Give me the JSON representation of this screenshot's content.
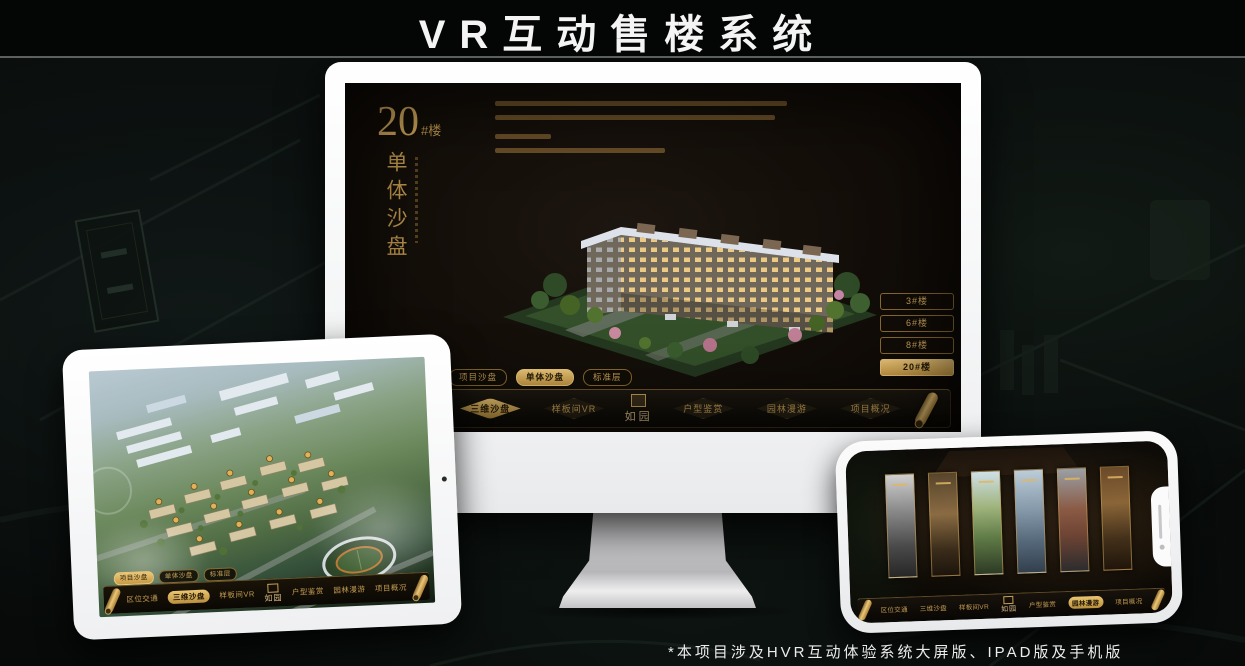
{
  "page": {
    "title": "VR互动售楼系统",
    "footnote": "*本项目涉及HVR互动体验系统大屏版、IPAD版及手机版"
  },
  "colors": {
    "gold": "#C9A158",
    "gold_bright": "#ECC779",
    "active_tab_bg": "#C79A44",
    "screen_bg": "#120D08",
    "title_text": "#F4F4F4"
  },
  "monitor": {
    "heading": {
      "number": "20",
      "suffix": "#楼",
      "vertical": "单体沙盘"
    },
    "floor_buttons": [
      {
        "label": "3#楼",
        "active": false
      },
      {
        "label": "6#楼",
        "active": false
      },
      {
        "label": "8#楼",
        "active": false
      },
      {
        "label": "20#楼",
        "active": true
      }
    ],
    "tabs": [
      {
        "label": "项目沙盘",
        "active": false
      },
      {
        "label": "单体沙盘",
        "active": true
      },
      {
        "label": "标准层",
        "active": false
      }
    ],
    "nav": {
      "left": [
        "区位交通",
        "三维沙盘",
        "样板间VR"
      ],
      "right": [
        "户型鉴赏",
        "园林漫游",
        "项目概况"
      ],
      "active": "三维沙盘",
      "logo": "如园"
    }
  },
  "tablet": {
    "tabs": [
      {
        "label": "项目沙盘",
        "active": true
      },
      {
        "label": "单体沙盘",
        "active": false
      },
      {
        "label": "标准层",
        "active": false
      }
    ],
    "nav": {
      "left": [
        "区位交通",
        "三维沙盘",
        "样板间VR"
      ],
      "right": [
        "户型鉴赏",
        "园林漫游",
        "项目概况"
      ],
      "active": "三维沙盘",
      "logo": "如园"
    }
  },
  "phone": {
    "nav": {
      "left": [
        "区位交通",
        "三维沙盘",
        "样板间VR"
      ],
      "right": [
        "户型鉴赏",
        "园林漫游",
        "项目概况"
      ],
      "active": "园林漫游",
      "logo": "如园"
    }
  }
}
